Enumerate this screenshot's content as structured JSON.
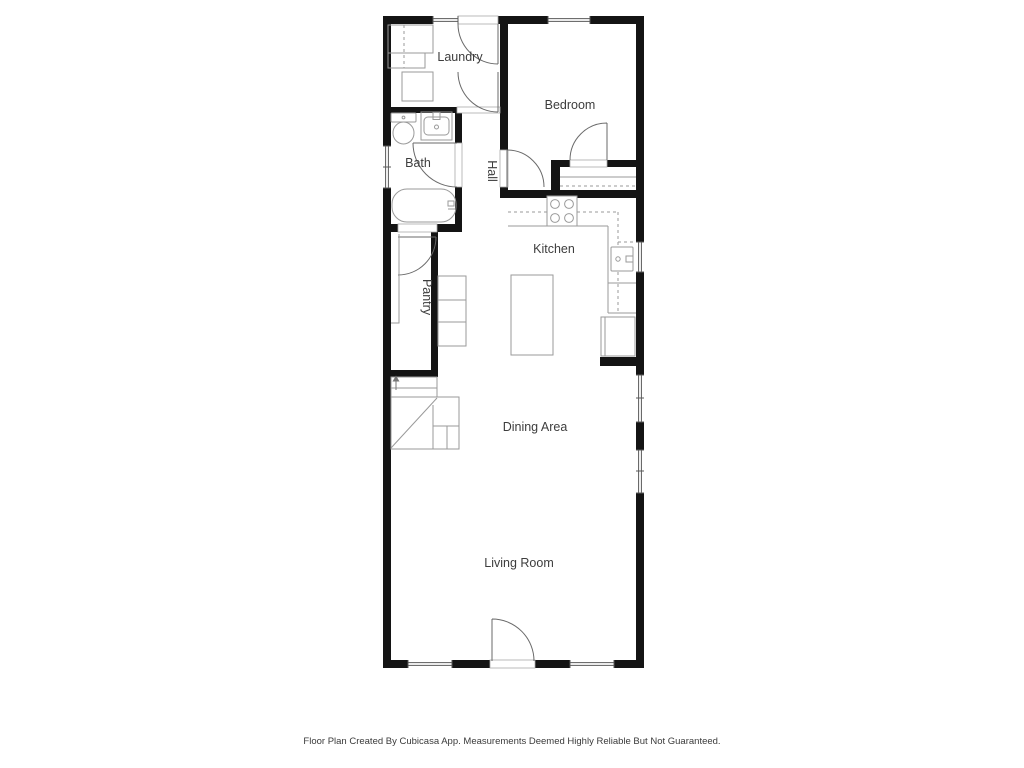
{
  "floor_plan": {
    "labels": {
      "laundry": "Laundry",
      "bedroom": "Bedroom",
      "bath": "Bath",
      "hall": "Hall",
      "kitchen": "Kitchen",
      "pantry": "Pantry",
      "dining_area": "Dining Area",
      "living_room": "Living Room"
    },
    "footer": "Floor Plan Created By Cubicasa App. Measurements Deemed Highly Reliable But Not Guaranteed.",
    "colors": {
      "wall": "#141414",
      "fixture_outline": "#9a9a9a",
      "door_arc": "#6a6a6a",
      "label_text": "#3d3d3d",
      "background": "#ffffff"
    }
  }
}
